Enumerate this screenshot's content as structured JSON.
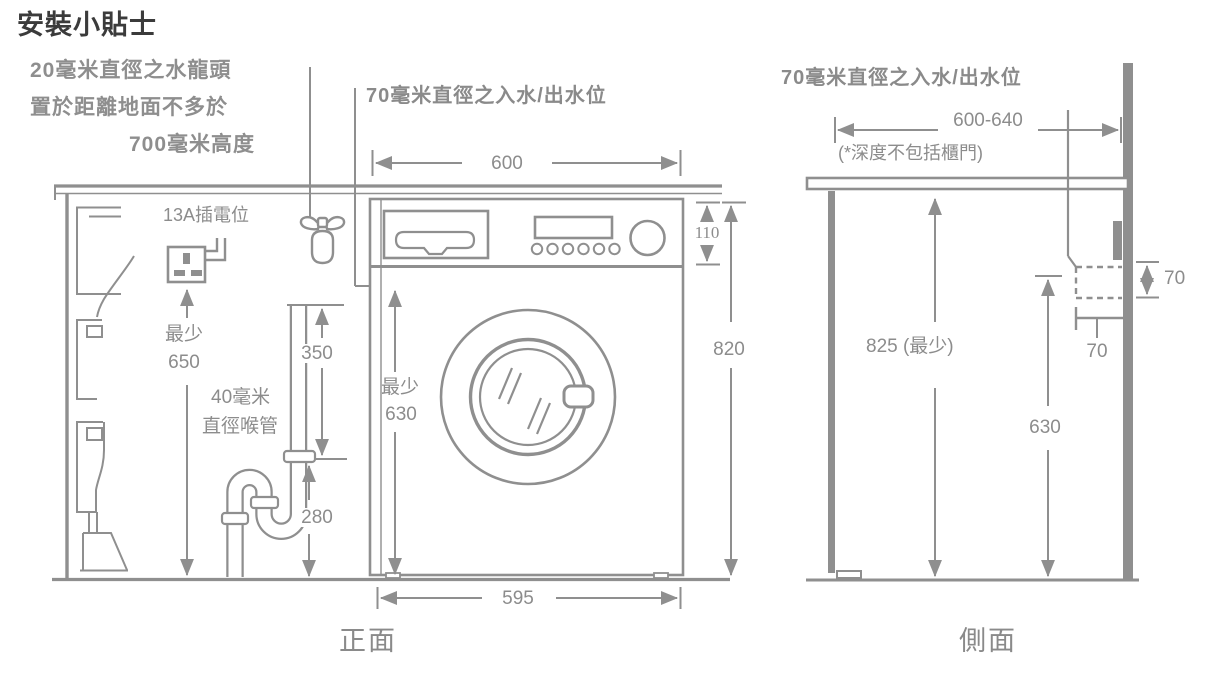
{
  "title": "安裝小貼士",
  "front_view": {
    "caption": "正面",
    "tap_note_line1": "20毫米直徑之水龍頭",
    "tap_note_line2": "置於距離地面不多於",
    "tap_note_line3": "700毫米高度",
    "inlet_outlet_label": "70毫米直徑之入水/出水位",
    "socket_label": "13A插電位",
    "drain_pipe_label_line1": "40毫米",
    "drain_pipe_label_line2": "直徑喉管",
    "dim_machine_top_width": "600",
    "dim_machine_bottom_width": "595",
    "dim_panel_height": "110",
    "dim_machine_height": "820",
    "dim_socket_min_label": "最少",
    "dim_socket_min_value": "650",
    "dim_standpipe_height": "350",
    "dim_trap_height": "280",
    "dim_inlet_min_label": "最少",
    "dim_inlet_min_value": "630"
  },
  "side_view": {
    "caption": "側面",
    "inlet_outlet_label": "70毫米直徑之入水/出水位",
    "dim_depth_range": "600-640",
    "depth_note": "(*深度不包括櫃門)",
    "dim_worktop_min_height": "825 (最少)",
    "dim_inlet_min_height": "630",
    "dim_outlet_height": "70",
    "dim_outlet_depth": "70"
  },
  "colors": {
    "line": "#8f8f8f",
    "label": "#8c8c8c",
    "title": "#3b3b3b"
  }
}
